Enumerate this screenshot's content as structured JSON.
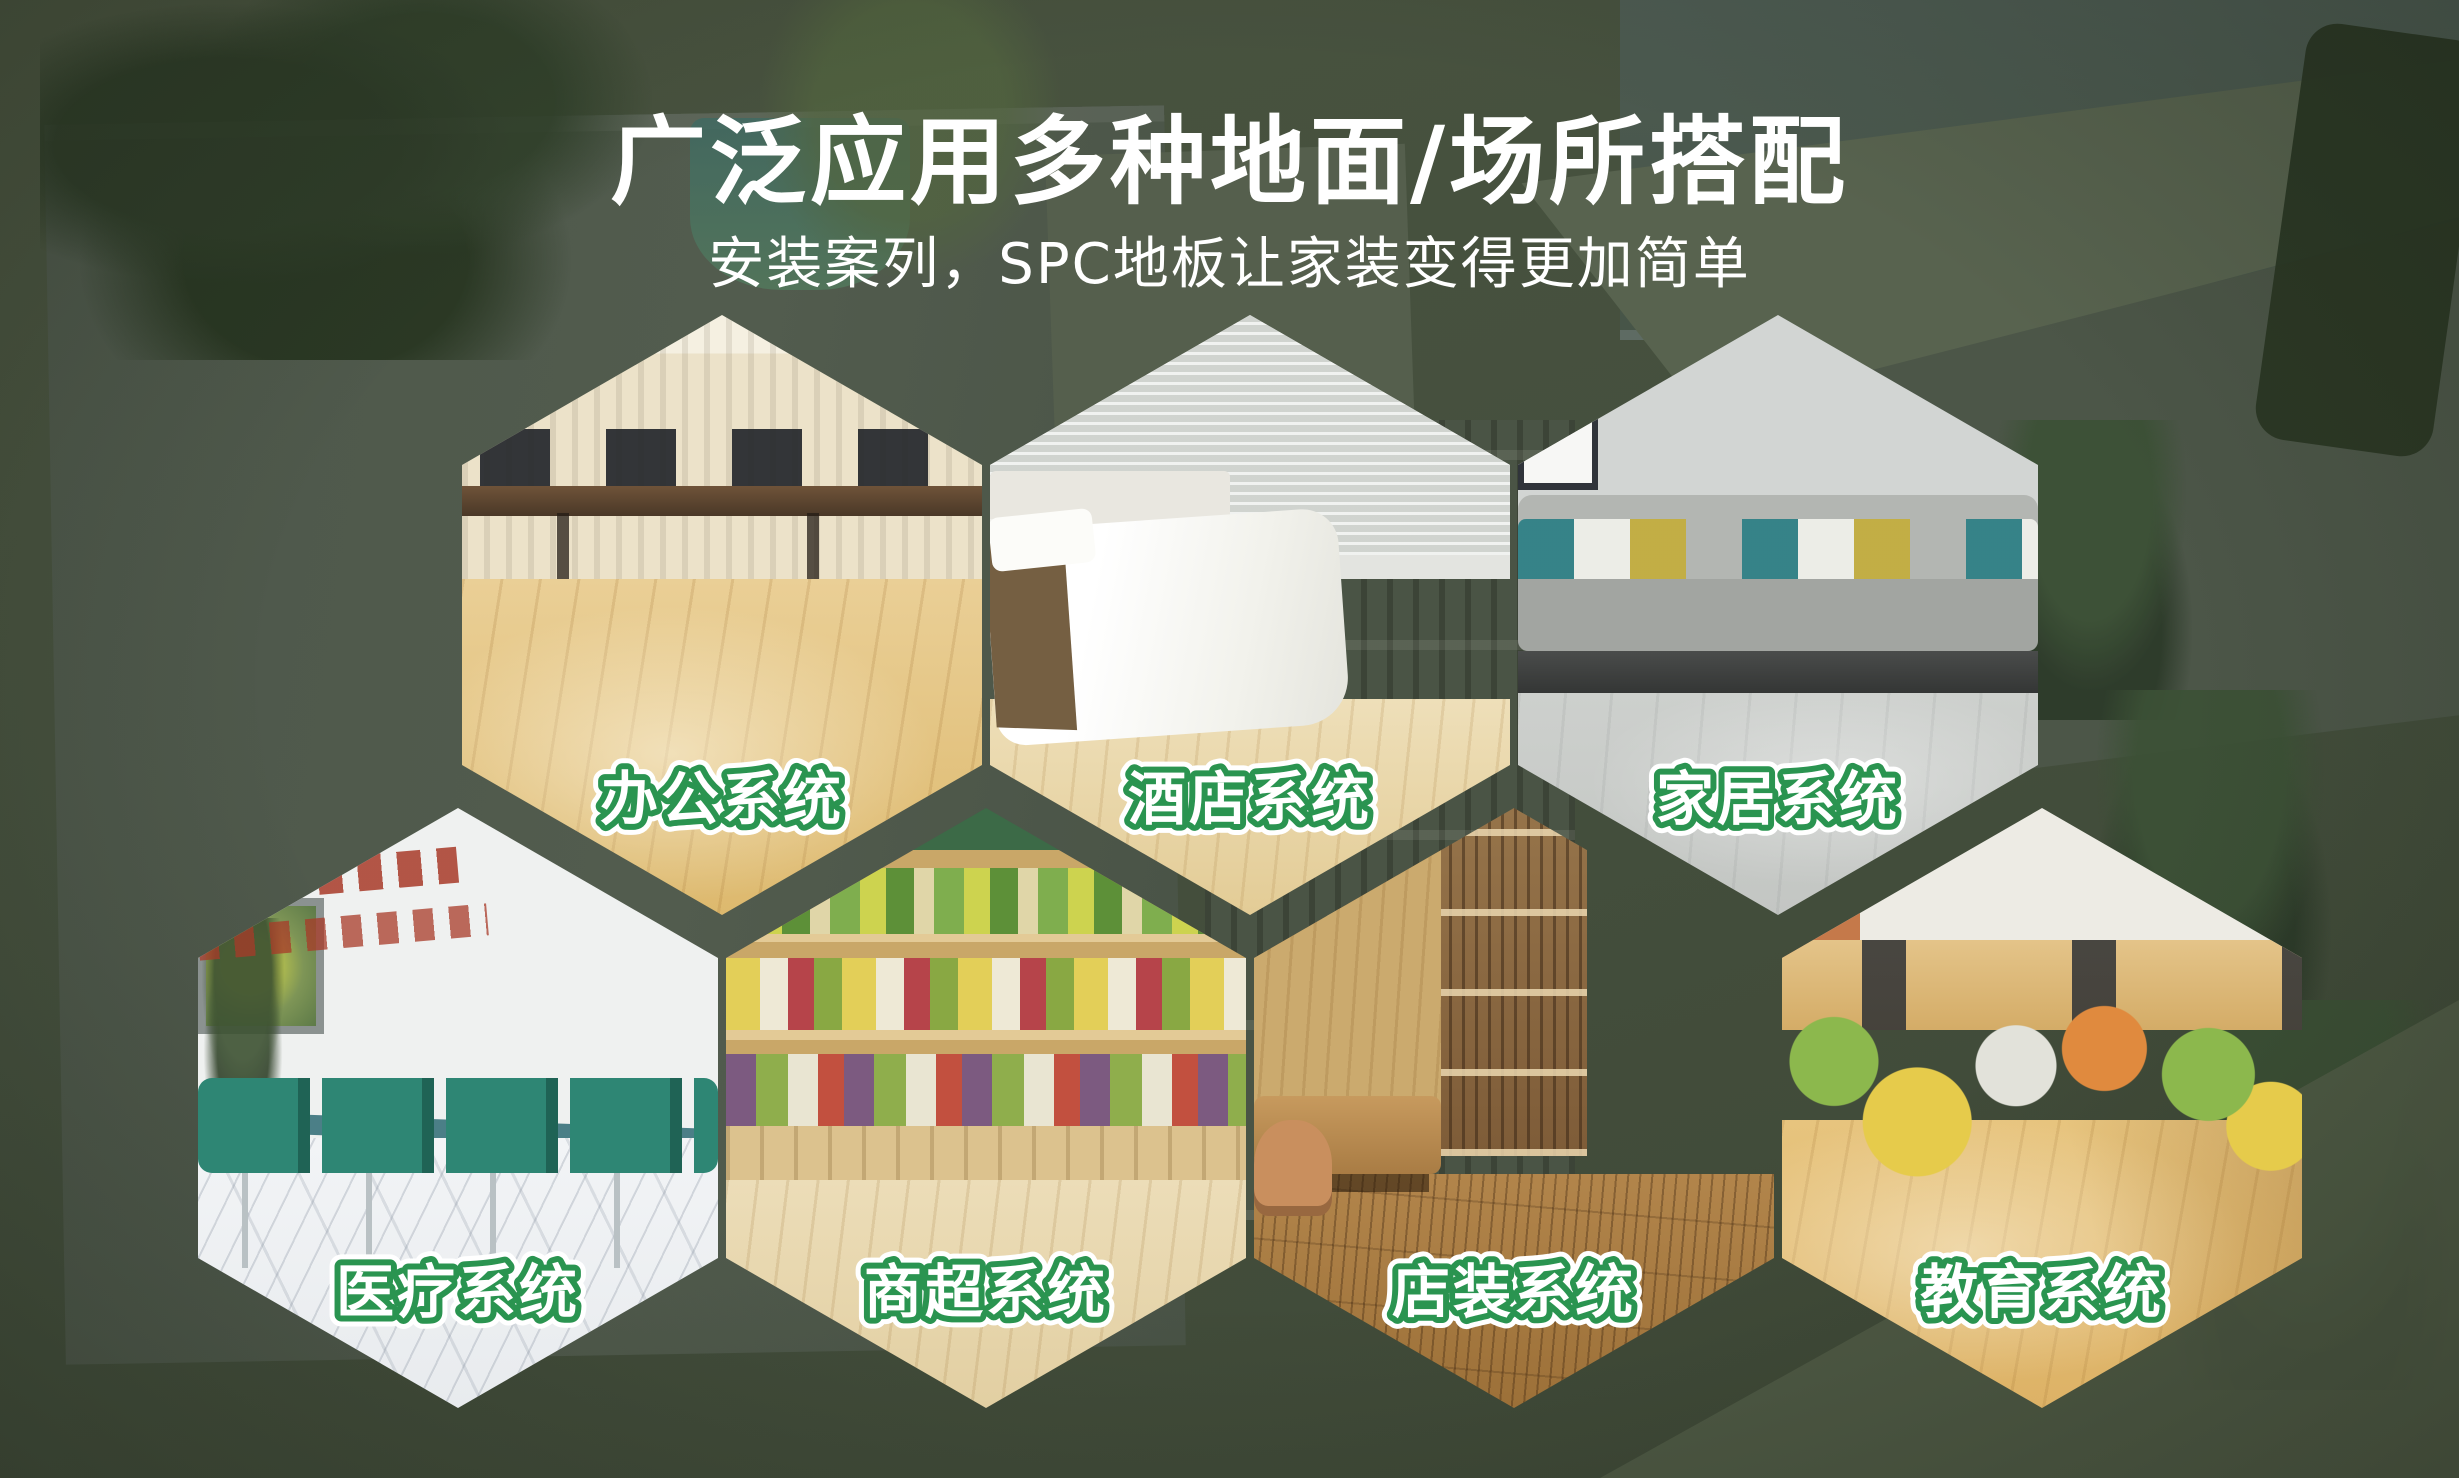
{
  "header": {
    "title": "广泛应用多种地面/场所搭配",
    "subtitle": "安装案列，SPC地板让家装变得更加简单"
  },
  "hexagons": [
    {
      "label": "办公系统",
      "scene": "office-workstations"
    },
    {
      "label": "酒店系统",
      "scene": "hotel-bedroom"
    },
    {
      "label": "家居系统",
      "scene": "home-living-room"
    },
    {
      "label": "医疗系统",
      "scene": "medical-waiting-area"
    },
    {
      "label": "商超系统",
      "scene": "supermarket-produce"
    },
    {
      "label": "店装系统",
      "scene": "store-cafe"
    },
    {
      "label": "教育系统",
      "scene": "education-classroom"
    }
  ],
  "colors": {
    "background_green": "#45503e",
    "label_stroke_green": "#2a9450",
    "label_fill": "#ffffff",
    "title_color": "#ffffff"
  }
}
